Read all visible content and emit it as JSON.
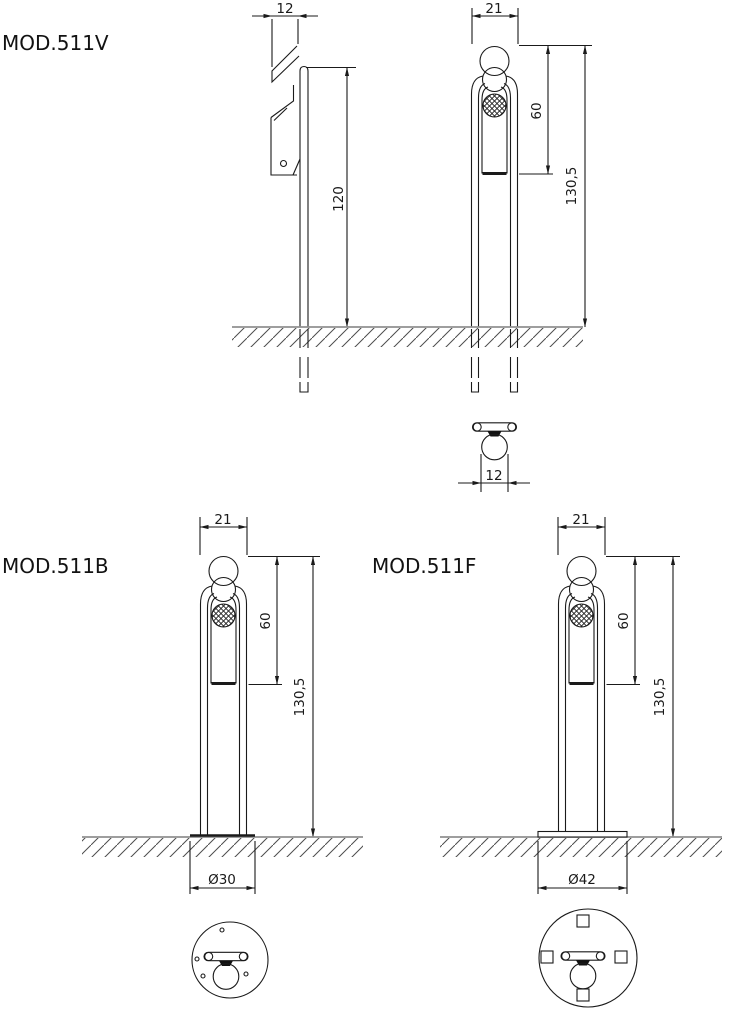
{
  "sheet": {
    "background": "#ffffff",
    "ink_color": "#1a1a1a",
    "ground_color": "#909090"
  },
  "models": [
    {
      "label": "MOD.511V",
      "dims": {
        "bracket_depth": "12",
        "head_width": "21",
        "panel_height": "60",
        "total_height": "130,5",
        "post_height": "120",
        "tube_diameter": "12"
      }
    },
    {
      "label": "MOD.511B",
      "dims": {
        "head_width": "21",
        "panel_height": "60",
        "total_height": "130,5",
        "base_diameter": "Ø30"
      }
    },
    {
      "label": "MOD.511F",
      "dims": {
        "head_width": "21",
        "panel_height": "60",
        "total_height": "130,5",
        "base_diameter": "Ø42"
      }
    }
  ]
}
